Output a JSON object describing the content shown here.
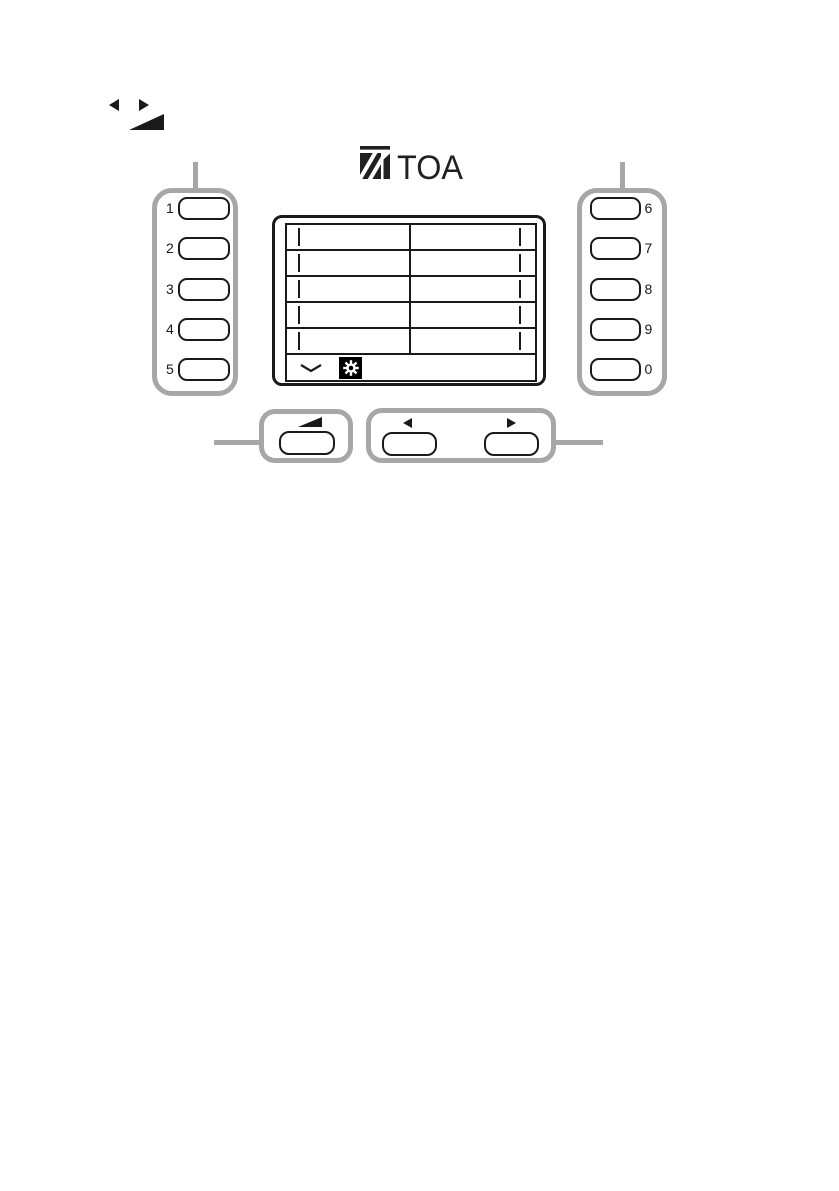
{
  "brand": {
    "logo_text": "TOA"
  },
  "legend_icons": [
    "left-arrow",
    "right-arrow",
    "volume-ramp"
  ],
  "left_keypad": {
    "keys": [
      {
        "label": "1"
      },
      {
        "label": "2"
      },
      {
        "label": "3"
      },
      {
        "label": "4"
      },
      {
        "label": "5"
      }
    ]
  },
  "right_keypad": {
    "keys": [
      {
        "label": "6"
      },
      {
        "label": "7"
      },
      {
        "label": "8"
      },
      {
        "label": "9"
      },
      {
        "label": "0"
      }
    ]
  },
  "display": {
    "grid_rows": 5,
    "grid_columns": 2,
    "footer_icons": [
      "scroll-down-chevron",
      "settings-gear"
    ]
  },
  "bottom_controls": {
    "volume_group_icon": "volume-ramp",
    "arrow_group_icons": [
      "left-arrow",
      "right-arrow"
    ]
  },
  "colors": {
    "ink": "#1a1a1a",
    "callout_gray": "#a7a7a7",
    "background": "#ffffff"
  }
}
